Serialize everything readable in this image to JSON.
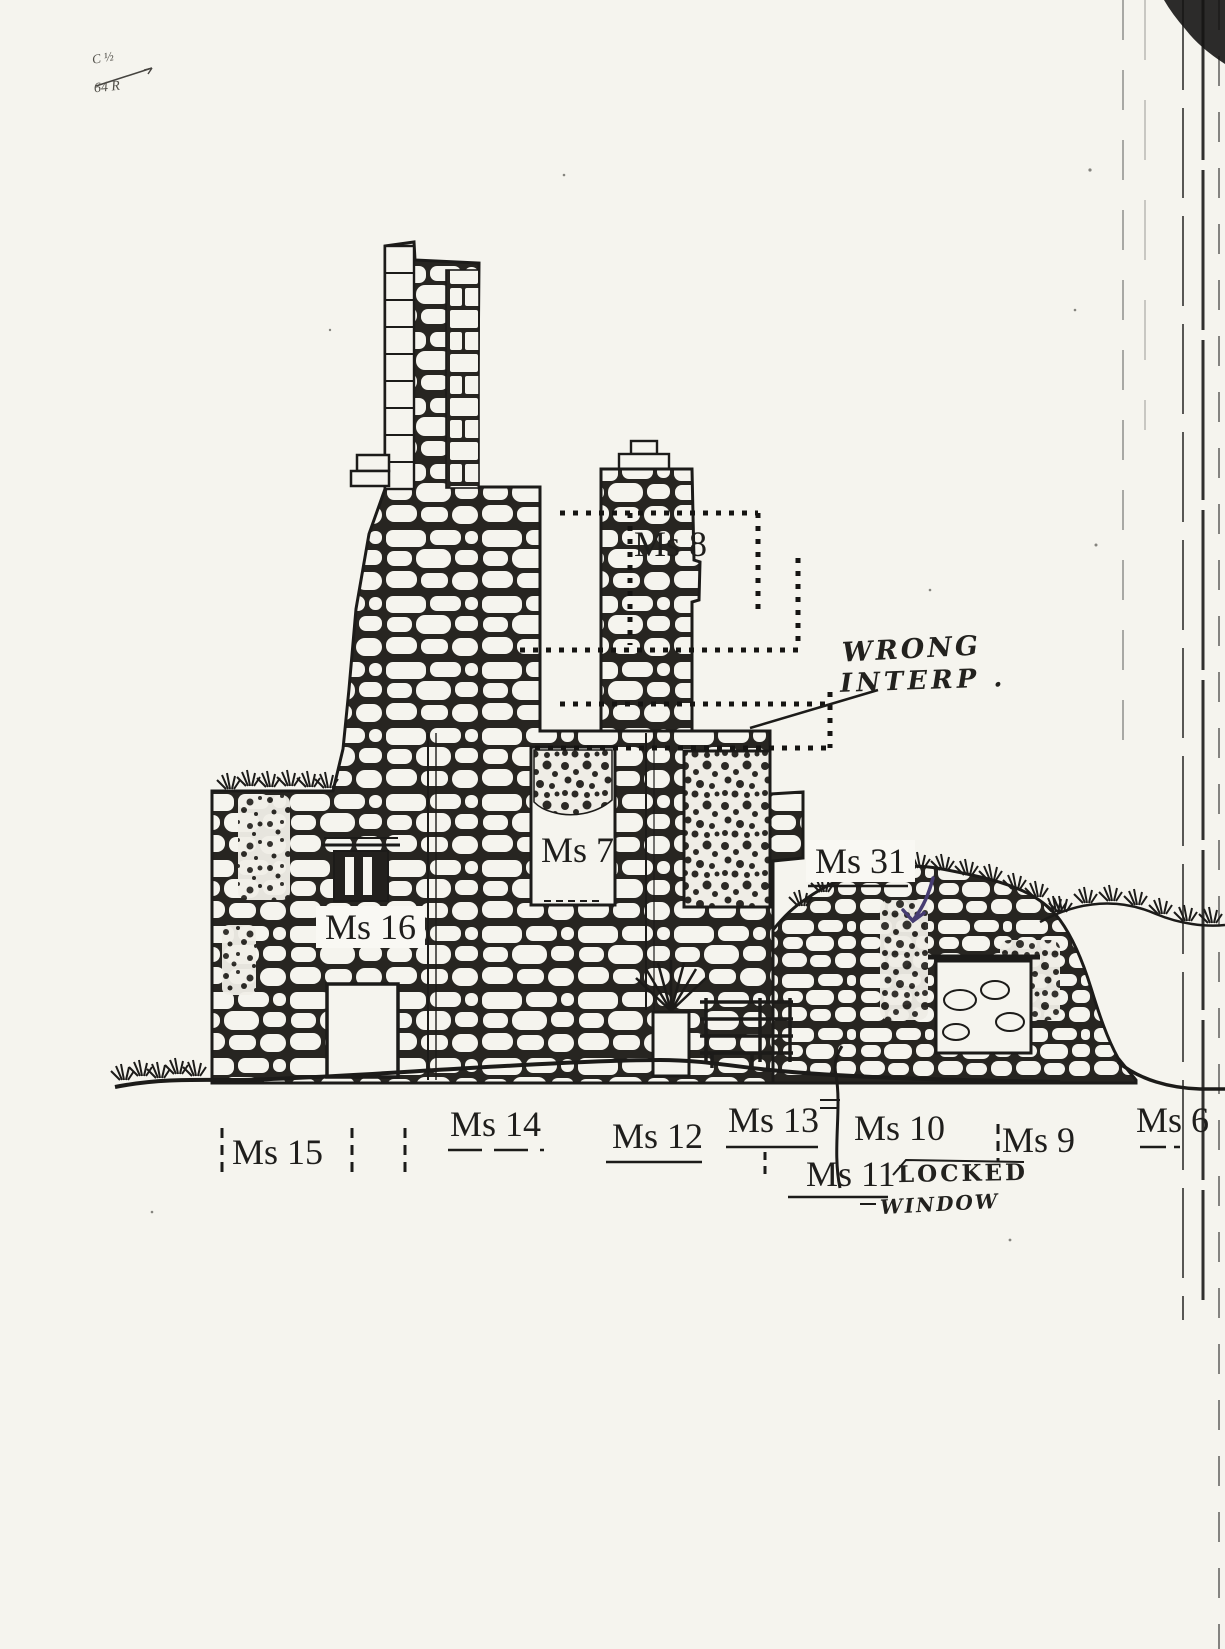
{
  "labels": {
    "ms8": "Ms 8",
    "ms7": "Ms 7",
    "ms16": "Ms 16",
    "ms31": "Ms 31",
    "ms15": "Ms 15",
    "ms14": "Ms 14",
    "ms12": "Ms 12",
    "ms13": "Ms 13",
    "ms10": "Ms 10",
    "ms11": "Ms 11",
    "ms9": "Ms 9",
    "ms6": "Ms 6"
  },
  "handwriting": {
    "wrong_interp_line1": "WRONG",
    "wrong_interp_line2": "INTERP .",
    "locked_line1": "LOCKED",
    "locked_line2": "WINDOW"
  },
  "scan_notes": {
    "corner_line1": "C ½",
    "corner_line2": "64 R"
  },
  "colors": {
    "ink": "#1c1b19",
    "annotation_pen": "#463c72",
    "paper": "#f5f4ee"
  }
}
